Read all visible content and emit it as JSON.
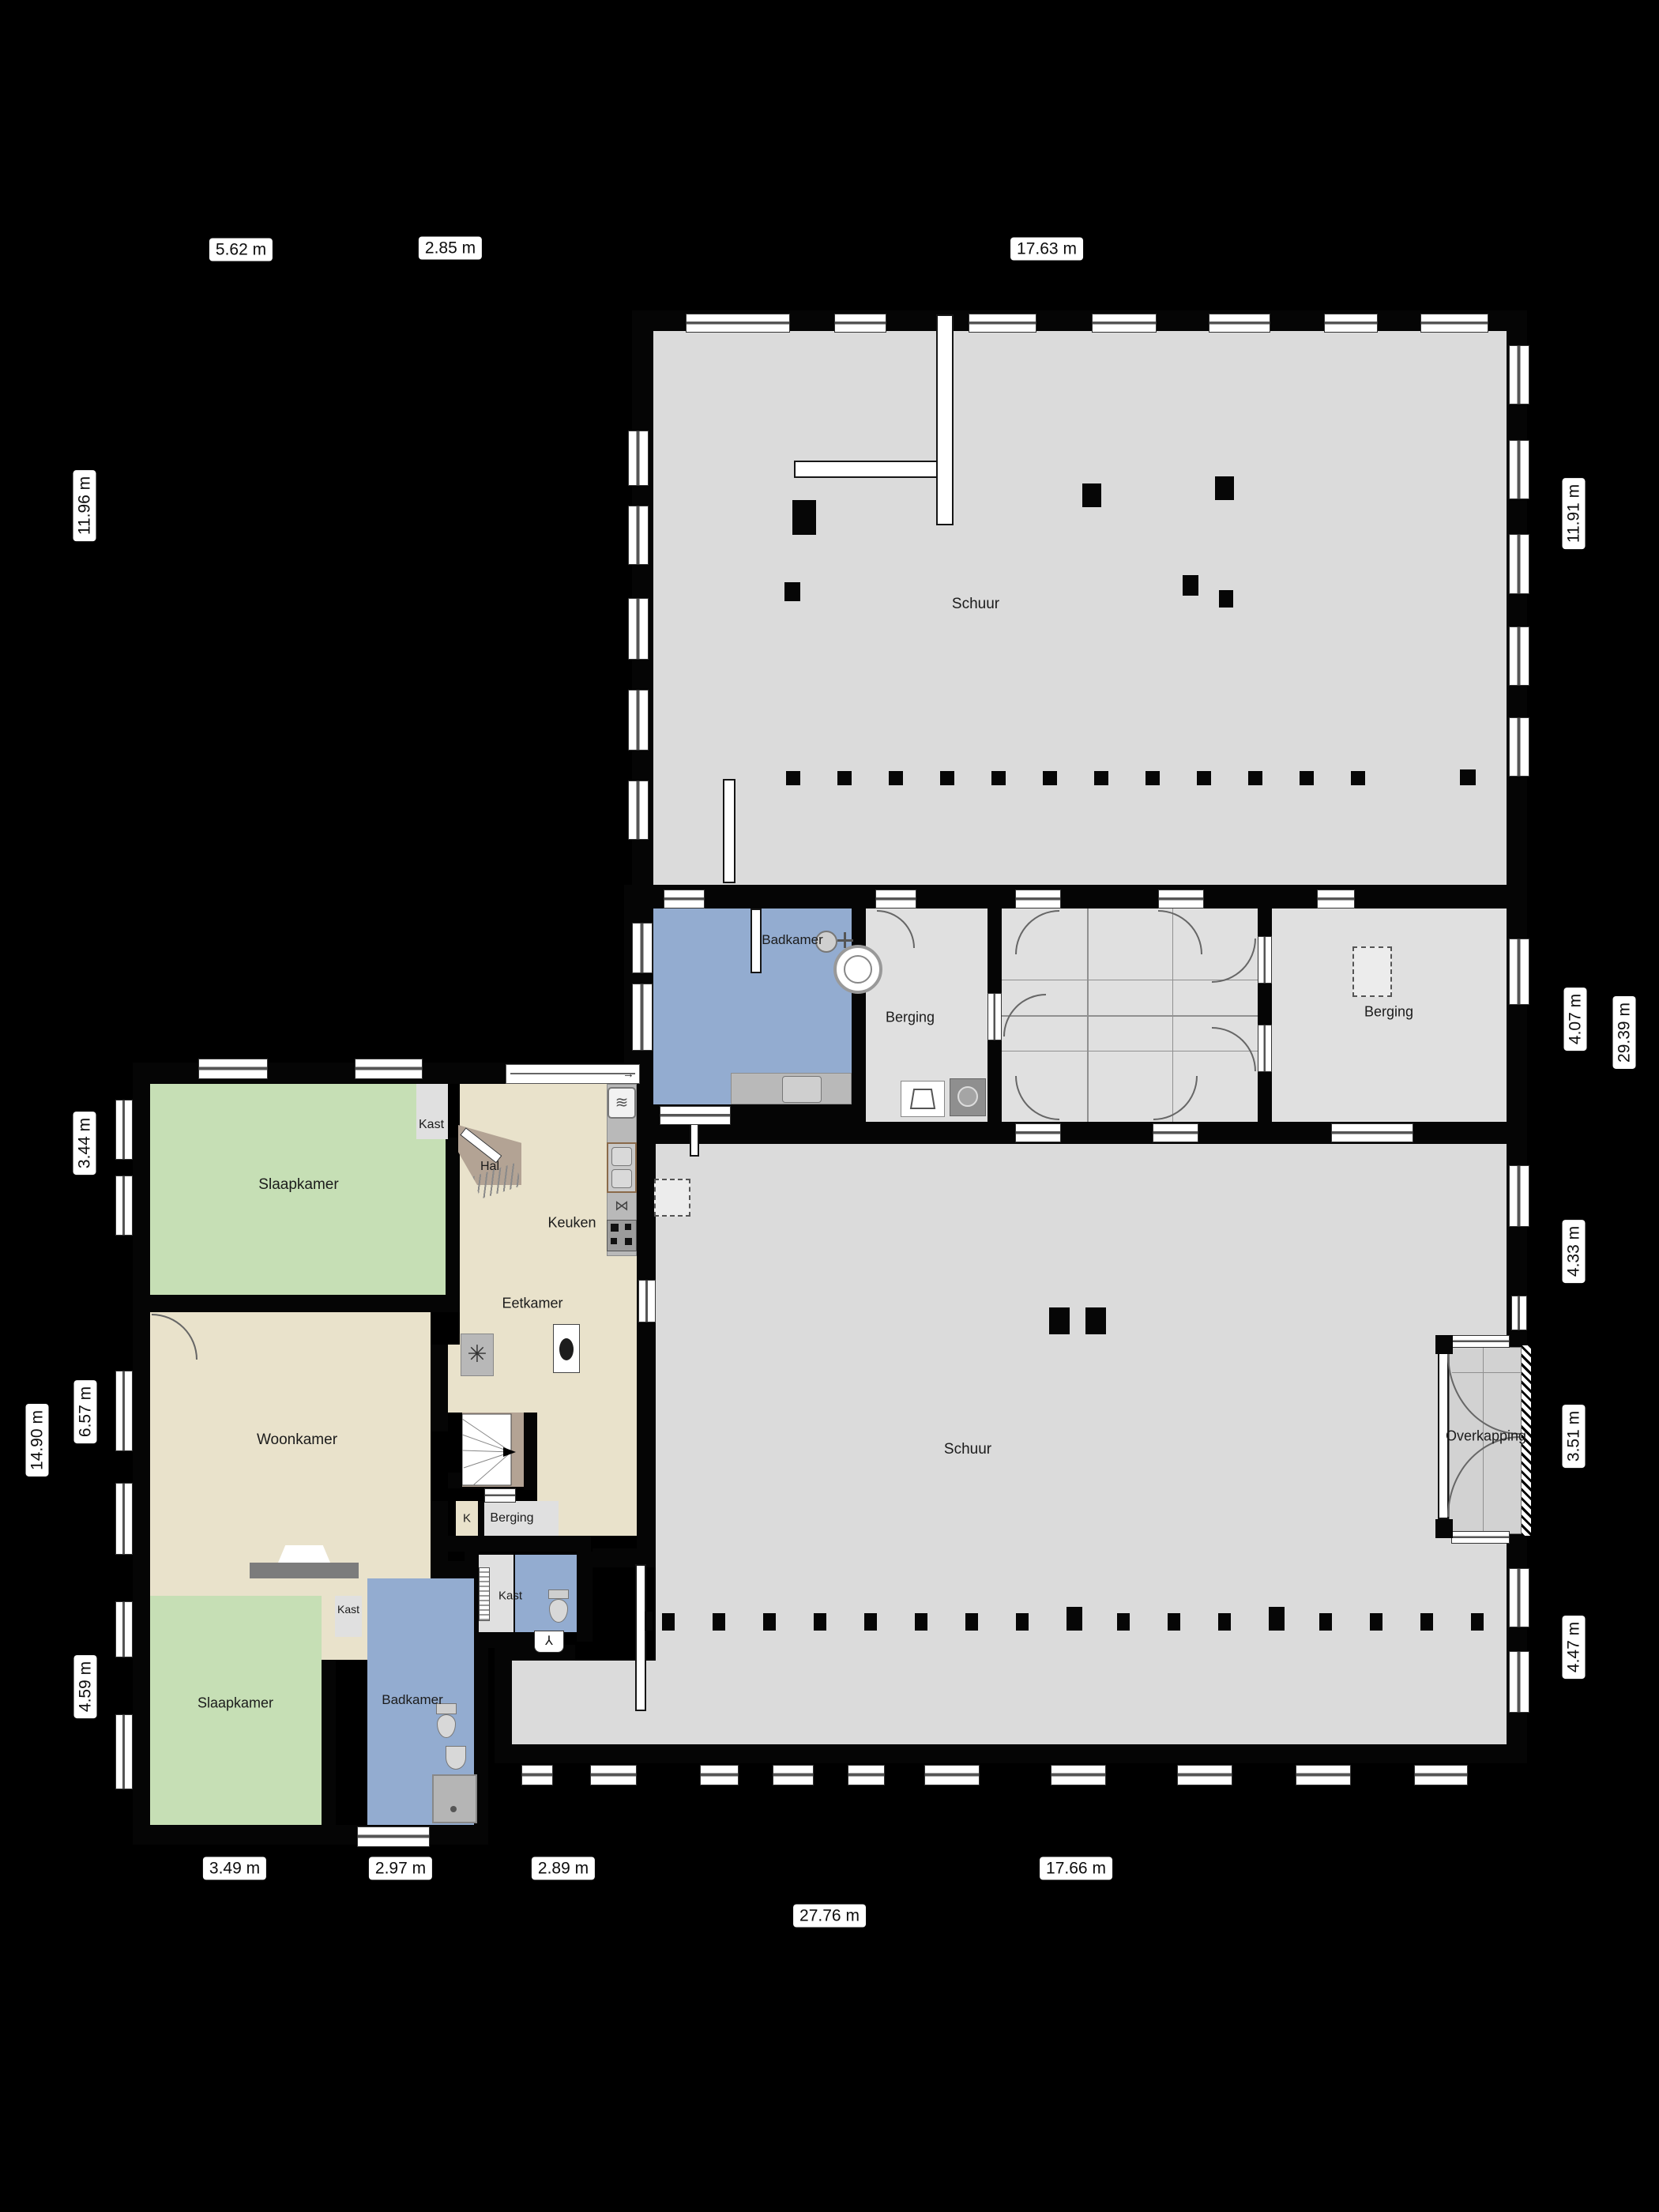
{
  "plan_type": "floor-plan (begane grond woonboerderij met schuren)",
  "rooms": {
    "schuur_top": "Schuur",
    "schuur_bottom": "Schuur",
    "overkapping": "Overkapping",
    "badkamer_mid": "Badkamer",
    "berging_mid": "Berging",
    "berging_right": "Berging",
    "slaapkamer_top": "Slaapkamer",
    "kast_top": "Kast",
    "hal": "Hal",
    "keuken": "Keuken",
    "eetkamer": "Eetkamer",
    "woonkamer": "Woonkamer",
    "k_closet": "K",
    "berging_house": "Berging",
    "kast_wc": "Kast",
    "slaapkamer_bottom": "Slaapkamer",
    "kast_bottom": "Kast",
    "badkamer_house": "Badkamer"
  },
  "dimensions": {
    "top": [
      "5.62 m",
      "2.85 m",
      "17.63 m"
    ],
    "bottom": [
      "3.49 m",
      "2.97 m",
      "2.89 m",
      "17.66 m",
      "27.76 m"
    ],
    "left": [
      "11.96 m",
      "3.44 m",
      "6.57 m",
      "14.90 m",
      "4.59 m"
    ],
    "right": [
      "11.91 m",
      "4.07 m",
      "29.39 m",
      "4.33 m",
      "3.51 m",
      "4.47 m"
    ]
  },
  "icons": {
    "kachel_icon": "✳",
    "fountain_icon": "⅄",
    "oven_steam_icon": "≋",
    "dishwasher_icon": "⋈",
    "entry_arrow": "→"
  },
  "colors": {
    "background": "#000000",
    "shed_floor": "#dbdbdb",
    "storage_floor": "#e0e0e0",
    "bedroom_green": "#c6dfb5",
    "bathroom_blue": "#93acd0",
    "living_beige": "#e9e2cb",
    "hall_tan": "#b3a394",
    "counter_gray": "#b9b9b9",
    "wall_black": "#050505"
  }
}
